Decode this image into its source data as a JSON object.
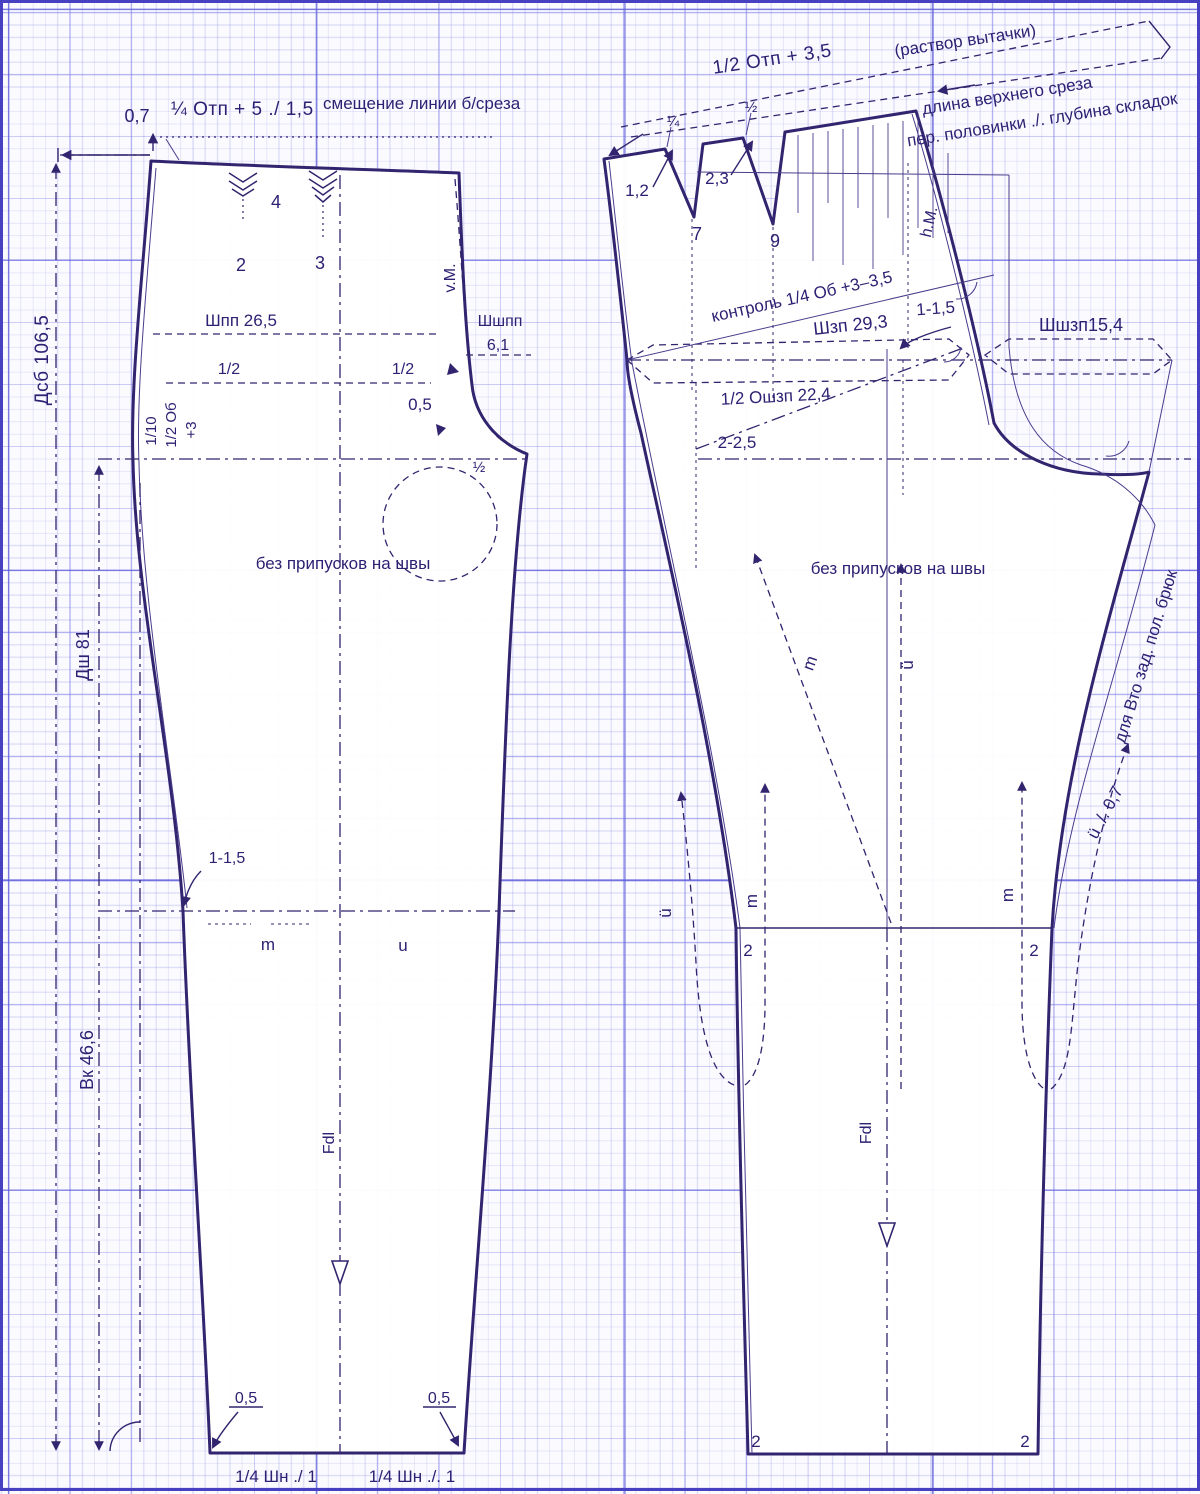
{
  "title": "Trouser pattern drafting diagram on graph paper",
  "colors": {
    "ink": "#32246e",
    "paper": "#fafaff",
    "grid_strong": "#5858d8",
    "grid_mid": "#7878e6",
    "grid_fine": "#8c8ce1",
    "frame": "#4740c0"
  },
  "labels": {
    "dims_left": {
      "dsb": "Дсб 106,5",
      "dsh": "Дш 81",
      "vk": "Вк 46,6"
    },
    "top_left": {
      "offset": "0,7",
      "formula": "¼ Отп + 5 ./ 1,5",
      "note": "смещение линии б/среза"
    },
    "front": {
      "pleat_2": "2",
      "pleat_3": "3",
      "pleat_4": "4",
      "vm": "v.M.",
      "shpp": "Шпп 26,5",
      "shshpp": "Шшпп",
      "shshpp_val": "6,1",
      "half_a": "1/2",
      "half_b": "1/2",
      "tenth": "1/10",
      "half_ob": "1/2 Об",
      "plus3": "+3",
      "half_c": "½",
      "half_cm": "0,5",
      "no_seam_allow": "без припусков на швы",
      "knee_in": "1-1,5",
      "m": "m",
      "u": "u",
      "fdl": "Fdl",
      "hem_left": "0,5",
      "hem_right": "0,5",
      "hem_f_left": "1/4 Шн ./ 1",
      "hem_f_right": "1/4 Шн ./. 1"
    },
    "back": {
      "dart_formula": "1/2 Отп + 3,5",
      "dart_note": "(раствор вытачки)",
      "edge_note1": "длина верхнего среза",
      "edge_note2": "пер. половинки ./. глубина складок",
      "q14": "¼",
      "q12": "½",
      "d12": "1,2",
      "d23": "2,3",
      "d7": "7",
      "d9": "9",
      "hm": "h.M.",
      "control": "контроль 1/4 Об +3–3,5",
      "shzp": "Шзп 29,3",
      "in115": "1-1,5",
      "shshzp": "Шшзп15,4",
      "oshzp": "1/2 Ошзп 22,4",
      "in225": "2-2,5",
      "no_seam_allow": "без припусков на швы",
      "m_diag": "m",
      "u_center": "ü",
      "u_left": "ü",
      "m_left": "m",
      "m_right": "m",
      "u_right": "ü ./. 0,7",
      "vto": "для Вто зад. пол. брюк",
      "fdl": "Fdl",
      "knee_l": "2",
      "knee_r": "2",
      "hem_l": "2",
      "hem_r": "2"
    }
  }
}
